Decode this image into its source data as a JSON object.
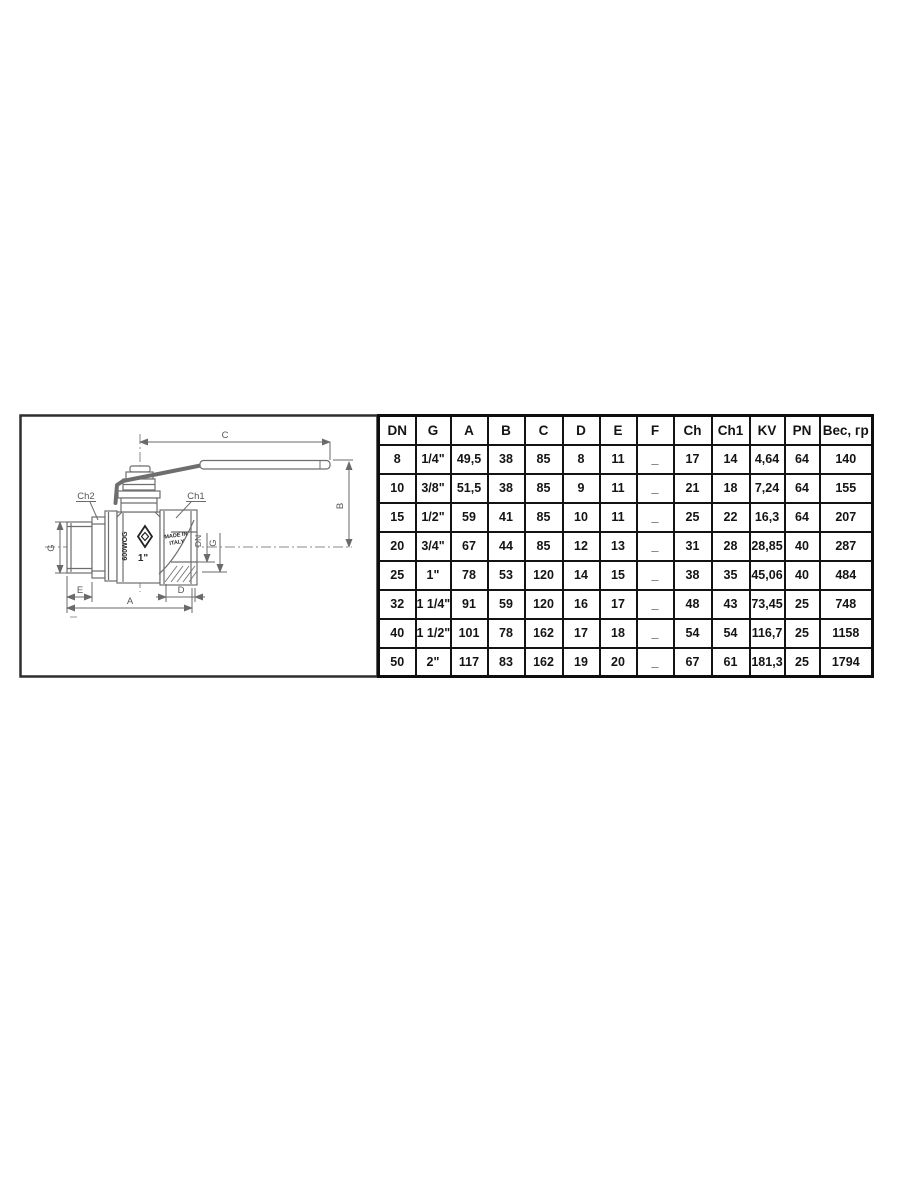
{
  "drawing": {
    "dimensions": {
      "c": "C",
      "b": "B",
      "a": "A",
      "e": "E",
      "d": "D",
      "g_left": "G",
      "g_right": "G",
      "dn": "DN"
    },
    "callouts": {
      "ch1": "Ch1",
      "ch2": "Ch2"
    },
    "valve_marks": {
      "rating": "600WOG",
      "size": "1\"",
      "origin_line1": "MADE IN",
      "origin_line2": "ITALY"
    }
  },
  "table": {
    "header_rows": [
      [
        "DN",
        "G",
        "A",
        "B",
        "C",
        "D",
        "E",
        "F",
        "Ch",
        "Ch1",
        "KV",
        "PN",
        "Вес, гр"
      ]
    ],
    "rows": [
      [
        "8",
        "1/4\"",
        "49,5",
        "38",
        "85",
        "8",
        "11",
        "_",
        "17",
        "14",
        "4,64",
        "64",
        "140"
      ],
      [
        "10",
        "3/8\"",
        "51,5",
        "38",
        "85",
        "9",
        "11",
        "_",
        "21",
        "18",
        "7,24",
        "64",
        "155"
      ],
      [
        "15",
        "1/2\"",
        "59",
        "41",
        "85",
        "10",
        "11",
        "_",
        "25",
        "22",
        "16,3",
        "64",
        "207"
      ],
      [
        "20",
        "3/4\"",
        "67",
        "44",
        "85",
        "12",
        "13",
        "_",
        "31",
        "28",
        "28,85",
        "40",
        "287"
      ],
      [
        "25",
        "1\"",
        "78",
        "53",
        "120",
        "14",
        "15",
        "_",
        "38",
        "35",
        "45,06",
        "40",
        "484"
      ],
      [
        "32",
        "1 1/4\"",
        "91",
        "59",
        "120",
        "16",
        "17",
        "_",
        "48",
        "43",
        "73,45",
        "25",
        "748"
      ],
      [
        "40",
        "1 1/2\"",
        "101",
        "78",
        "162",
        "17",
        "18",
        "_",
        "54",
        "54",
        "116,7",
        "25",
        "1158"
      ],
      [
        "50",
        "2\"",
        "117",
        "83",
        "162",
        "19",
        "20",
        "_",
        "67",
        "61",
        "181,3",
        "25",
        "1794"
      ]
    ]
  },
  "colors": {
    "table_border": "#131313",
    "table_text": "#141414",
    "drawing_line": "#6e6e6e",
    "label_text": "#565656",
    "mark_text": "#2a2a2a"
  }
}
